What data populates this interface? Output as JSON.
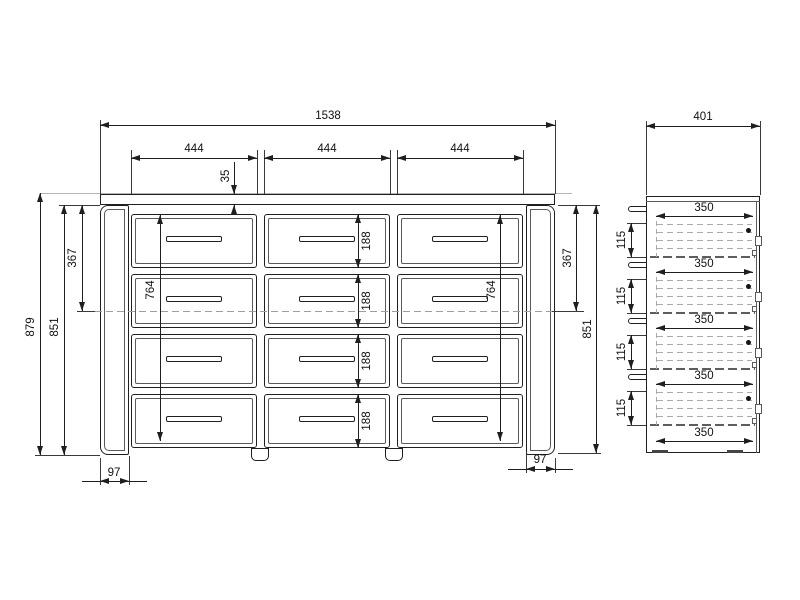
{
  "front_view": {
    "overall_width": "1538",
    "drawer_widths": [
      "444",
      "444",
      "444"
    ],
    "top_thickness": "35",
    "overall_height": "879",
    "drawer_heights": [
      "188",
      "188",
      "188",
      "188"
    ],
    "left": {
      "carcass_height": "851",
      "top_to_reference": "367",
      "drawer_bank_height": "764",
      "side_panel_width": "97"
    },
    "right": {
      "carcass_height": "851",
      "top_to_reference": "367",
      "drawer_bank_height": "764",
      "side_panel_width": "97"
    }
  },
  "side_view": {
    "overall_depth": "401",
    "runner_depths": [
      "350",
      "350",
      "350",
      "350",
      "350"
    ],
    "drawer_side_heights": [
      "115",
      "115",
      "115",
      "115"
    ]
  },
  "style": {
    "object_line_color": "#1f1f1f",
    "hidden_line_color": "#9e9e9e",
    "background": "#ffffff"
  }
}
